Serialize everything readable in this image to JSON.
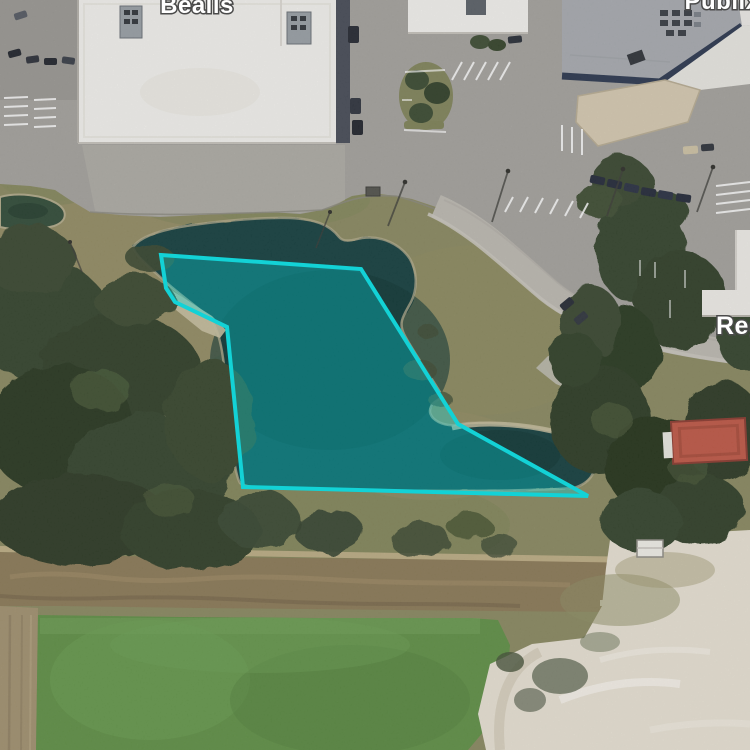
{
  "map": {
    "view": "satellite",
    "labels": [
      {
        "text": "Bealls",
        "x": 197,
        "y": 13,
        "font_size": 24
      },
      {
        "text": "Publix",
        "x": 722,
        "y": 9,
        "font_size": 24
      },
      {
        "text": "Reg",
        "x": 716,
        "y": 334,
        "font_size": 25
      }
    ],
    "parcel": {
      "points": "161,255 361,269 458,424 588,496 243,487 227,327 175,302 166,288",
      "stroke": "#13d2d6",
      "fill": "rgba(0,225,230,0.32)",
      "stroke_width": 4
    },
    "label_color": "#ffffff",
    "label_outline": "#4b4b4b"
  }
}
